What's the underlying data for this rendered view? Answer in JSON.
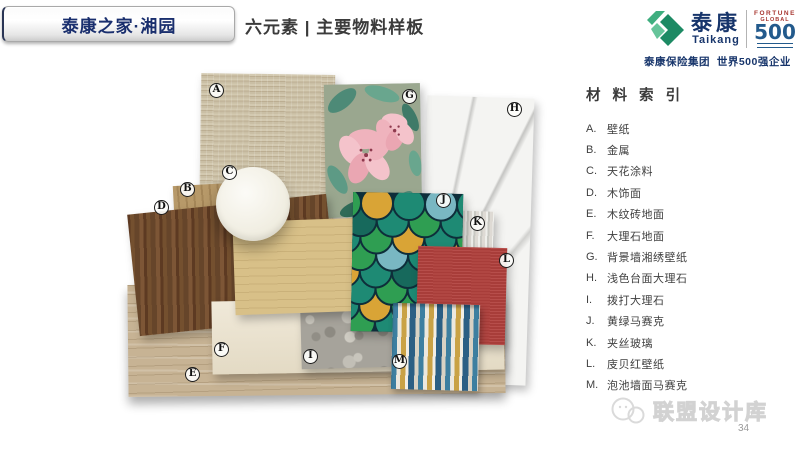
{
  "page": {
    "page_number": "34",
    "background": "#ffffff"
  },
  "header": {
    "banner": {
      "label": "泰康之家·湘园",
      "text_color": "#1a2f6e"
    },
    "title": "六元素 | 主要物料样板",
    "logo": {
      "brand_cn": "泰康",
      "brand_en": "Taikang",
      "fortune_line1": "FORTUNE",
      "fortune_line2": "GLOBAL",
      "fortune_number": "500",
      "tagline": "泰康保险集团  世界500强企业",
      "brand_color": "#17356b",
      "logo_green": "#2fa474",
      "fortune_blue": "#235a8c"
    }
  },
  "index_panel": {
    "title": "材 料 索 引",
    "items": [
      {
        "letter": "A.",
        "label": "壁纸"
      },
      {
        "letter": "B.",
        "label": "金属"
      },
      {
        "letter": "C.",
        "label": "天花涂料"
      },
      {
        "letter": "D.",
        "label": "木饰面"
      },
      {
        "letter": "E.",
        "label": "木纹砖地面"
      },
      {
        "letter": "F.",
        "label": "大理石地面"
      },
      {
        "letter": "G.",
        "label": "背景墙湘绣壁纸"
      },
      {
        "letter": "H.",
        "label": "浅色台面大理石"
      },
      {
        "letter": "I.",
        "label": "拨打大理石"
      },
      {
        "letter": "J.",
        "label": "黄绿马赛克"
      },
      {
        "letter": "K.",
        "label": "夹丝玻璃"
      },
      {
        "letter": "L.",
        "label": "庋贝红壁纸"
      },
      {
        "letter": "M.",
        "label": "泡池墙面马赛克"
      }
    ]
  },
  "collage": {
    "labels": [
      "A",
      "B",
      "C",
      "D",
      "E",
      "F",
      "G",
      "H",
      "I",
      "J",
      "K",
      "L",
      "M"
    ],
    "material_colors": {
      "grasscloth_wallpaper": "#cabfa5",
      "floral_wallpaper_bg": "#9aa78f",
      "floral_pink": "#efb3bd",
      "floral_leaf": "#4d8a77",
      "white_marble": "#f4f4f2",
      "tan_wood": "#b79969",
      "walnut_wood": "#6a4428",
      "ceiling_paint_disc": "#f4f1e6",
      "wood_grain_tile": "#c7b394",
      "cream_marble": "#eae1cd",
      "maple_wood": "#d8c088",
      "mosaic_teal": "#1e8a74",
      "mosaic_green": "#2f9e52",
      "mosaic_amber": "#d9a436",
      "wired_glass": "#dedad4",
      "red_wallpaper": "#b2413d",
      "gray_stone": "#a6a39b",
      "strip_mosaic_blue": "#3d7fa0",
      "strip_mosaic_gold": "#c9a245"
    }
  },
  "watermark": {
    "text": "联盟设计库",
    "icon": "wechat-icon"
  }
}
